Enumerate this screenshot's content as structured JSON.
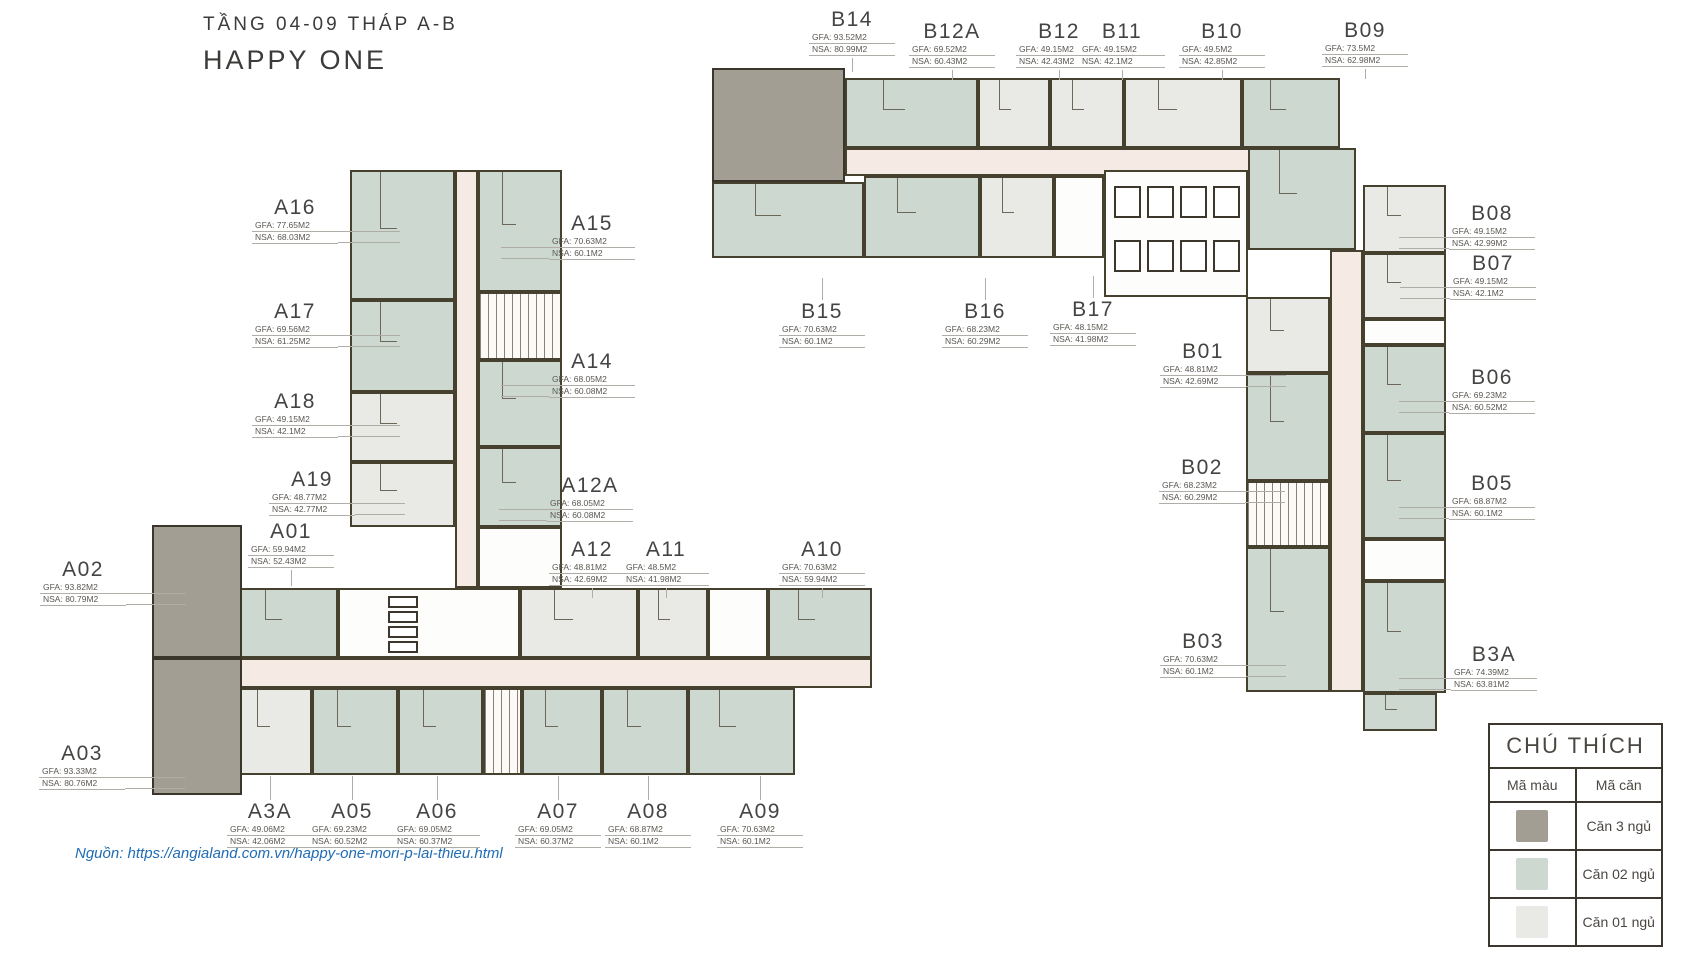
{
  "header": {
    "floor_line": "TẦNG 04-09 THÁP A-B",
    "project_line": "HAPPY ONE"
  },
  "source": {
    "text": "Nguồn: https://angialand.com.vn/happy-one-mori-p-lai-thieu.html"
  },
  "legend": {
    "title": "CHÚ THÍCH",
    "columns": [
      "Mã màu",
      "Mã căn"
    ],
    "rows": [
      {
        "color": "#a29e93",
        "label": "Căn 3 ngủ"
      },
      {
        "color": "#cdd8d1",
        "label": "Căn 02 ngủ"
      },
      {
        "color": "#e9eae6",
        "label": "Căn 01 ngủ"
      }
    ]
  },
  "colors": {
    "wall": "#46402f",
    "corridor": "#f6ebe4",
    "one_bed": "#e9eae6",
    "two_bed": "#cdd8d1",
    "three_bed": "#a29e93"
  },
  "units": [
    {
      "id": "A16",
      "gfa": "GFA: 77.65M2",
      "nsa": "NSA: 68.03M2",
      "cx": 295,
      "y": 196,
      "side": "right",
      "len": 62
    },
    {
      "id": "A17",
      "gfa": "GFA: 69.56M2",
      "nsa": "NSA: 61.25M2",
      "cx": 295,
      "y": 300,
      "side": "right",
      "len": 62
    },
    {
      "id": "A18",
      "gfa": "GFA: 49.15M2",
      "nsa": "NSA: 42.1M2",
      "cx": 295,
      "y": 390,
      "side": "right",
      "len": 62
    },
    {
      "id": "A19",
      "gfa": "GFA: 48.77M2",
      "nsa": "NSA: 42.77M2",
      "cx": 312,
      "y": 468,
      "side": "right",
      "len": 50
    },
    {
      "id": "A01",
      "gfa": "GFA: 59.94M2",
      "nsa": "NSA: 52.43M2",
      "cx": 291,
      "y": 520,
      "side": "down",
      "len": 16
    },
    {
      "id": "A02",
      "gfa": "GFA: 93.82M2",
      "nsa": "NSA: 80.79M2",
      "cx": 83,
      "y": 558,
      "side": "right",
      "len": 60
    },
    {
      "id": "A03",
      "gfa": "GFA: 93.33M2",
      "nsa": "NSA: 80.76M2",
      "cx": 82,
      "y": 742,
      "side": "right",
      "len": 60
    },
    {
      "id": "A3A",
      "gfa": "GFA: 49.06M2",
      "nsa": "NSA: 42.06M2",
      "cx": 270,
      "y": 800,
      "side": "up",
      "len": 24
    },
    {
      "id": "A05",
      "gfa": "GFA: 69.23M2",
      "nsa": "NSA: 60.52M2",
      "cx": 352,
      "y": 800,
      "side": "up",
      "len": 24
    },
    {
      "id": "A06",
      "gfa": "GFA: 69.05M2",
      "nsa": "NSA: 60.37M2",
      "cx": 437,
      "y": 800,
      "side": "up",
      "len": 24
    },
    {
      "id": "A07",
      "gfa": "GFA: 69.05M2",
      "nsa": "NSA: 60.37M2",
      "cx": 558,
      "y": 800,
      "side": "up",
      "len": 24
    },
    {
      "id": "A08",
      "gfa": "GFA: 68.87M2",
      "nsa": "NSA: 60.1M2",
      "cx": 648,
      "y": 800,
      "side": "up",
      "len": 24
    },
    {
      "id": "A09",
      "gfa": "GFA: 70.63M2",
      "nsa": "NSA: 60.1M2",
      "cx": 760,
      "y": 800,
      "side": "up",
      "len": 24
    },
    {
      "id": "A10",
      "gfa": "GFA: 70.63M2",
      "nsa": "NSA: 59.94M2",
      "cx": 822,
      "y": 538,
      "side": "down",
      "len": 10
    },
    {
      "id": "A11",
      "gfa": "GFA: 48.5M2",
      "nsa": "NSA: 41.98M2",
      "cx": 666,
      "y": 538,
      "side": "down",
      "len": 10
    },
    {
      "id": "A12",
      "gfa": "GFA: 48.81M2",
      "nsa": "NSA: 42.69M2",
      "cx": 592,
      "y": 538,
      "side": "down",
      "len": 10
    },
    {
      "id": "A12A",
      "gfa": "GFA: 68.05M2",
      "nsa": "NSA: 60.08M2",
      "cx": 590,
      "y": 474,
      "side": "left",
      "len": 48
    },
    {
      "id": "A14",
      "gfa": "GFA: 68.05M2",
      "nsa": "NSA: 60.08M2",
      "cx": 592,
      "y": 350,
      "side": "left",
      "len": 48
    },
    {
      "id": "A15",
      "gfa": "GFA: 70.63M2",
      "nsa": "NSA: 60.1M2",
      "cx": 592,
      "y": 212,
      "side": "left",
      "len": 48
    },
    {
      "id": "B14",
      "gfa": "GFA: 93.52M2",
      "nsa": "NSA: 80.99M2",
      "cx": 852,
      "y": 8,
      "side": "down",
      "len": 14
    },
    {
      "id": "B12A",
      "gfa": "GFA: 69.52M2",
      "nsa": "NSA: 60.43M2",
      "cx": 952,
      "y": 20,
      "side": "down",
      "len": 10
    },
    {
      "id": "B12",
      "gfa": "GFA: 49.15M2",
      "nsa": "NSA: 42.43M2",
      "cx": 1059,
      "y": 20,
      "side": "down",
      "len": 10
    },
    {
      "id": "B11",
      "gfa": "GFA: 49.15M2",
      "nsa": "NSA: 42.1M2",
      "cx": 1122,
      "y": 20,
      "side": "down",
      "len": 10
    },
    {
      "id": "B10",
      "gfa": "GFA: 49.5M2",
      "nsa": "NSA: 42.85M2",
      "cx": 1222,
      "y": 20,
      "side": "down",
      "len": 10
    },
    {
      "id": "B09",
      "gfa": "GFA: 73.5M2",
      "nsa": "NSA: 62.98M2",
      "cx": 1365,
      "y": 19,
      "side": "down",
      "len": 10
    },
    {
      "id": "B15",
      "gfa": "GFA: 70.63M2",
      "nsa": "NSA: 60.1M2",
      "cx": 822,
      "y": 300,
      "side": "up",
      "len": 22
    },
    {
      "id": "B16",
      "gfa": "GFA: 68.23M2",
      "nsa": "NSA: 60.29M2",
      "cx": 985,
      "y": 300,
      "side": "up",
      "len": 22
    },
    {
      "id": "B17",
      "gfa": "GFA: 48.15M2",
      "nsa": "NSA: 41.98M2",
      "cx": 1093,
      "y": 298,
      "side": "up",
      "len": 22
    },
    {
      "id": "B01",
      "gfa": "GFA: 48.81M2",
      "nsa": "NSA: 42.69M2",
      "cx": 1203,
      "y": 340,
      "side": "right",
      "len": 40
    },
    {
      "id": "B02",
      "gfa": "GFA: 68.23M2",
      "nsa": "NSA: 60.29M2",
      "cx": 1202,
      "y": 456,
      "side": "right",
      "len": 40
    },
    {
      "id": "B03",
      "gfa": "GFA: 70.63M2",
      "nsa": "NSA: 60.1M2",
      "cx": 1203,
      "y": 630,
      "side": "right",
      "len": 40
    },
    {
      "id": "B08",
      "gfa": "GFA: 49.15M2",
      "nsa": "NSA: 42.99M2",
      "cx": 1492,
      "y": 202,
      "side": "left",
      "len": 50
    },
    {
      "id": "B07",
      "gfa": "GFA: 49.15M2",
      "nsa": "NSA: 42.1M2",
      "cx": 1493,
      "y": 252,
      "side": "left",
      "len": 50
    },
    {
      "id": "B06",
      "gfa": "GFA: 69.23M2",
      "nsa": "NSA: 60.52M2",
      "cx": 1492,
      "y": 366,
      "side": "left",
      "len": 50
    },
    {
      "id": "B05",
      "gfa": "GFA: 68.87M2",
      "nsa": "NSA: 60.1M2",
      "cx": 1492,
      "y": 472,
      "side": "left",
      "len": 50
    },
    {
      "id": "B3A",
      "gfa": "GFA: 74.39M2",
      "nsa": "NSA: 63.81M2",
      "cx": 1494,
      "y": 643,
      "side": "left",
      "len": 52
    }
  ]
}
